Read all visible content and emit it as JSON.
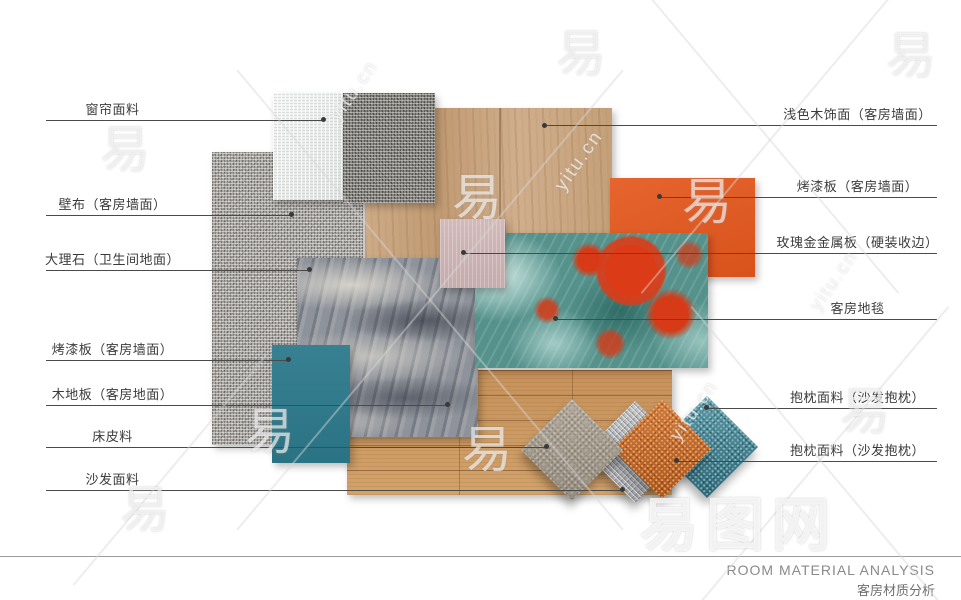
{
  "left_labels": [
    {
      "text": "窗帘面料",
      "material": "curtain-fabric"
    },
    {
      "text": "壁布（客房墙面）",
      "material": "wall-fabric"
    },
    {
      "text": "大理石（卫生间地面）",
      "material": "marble-bathroom-floor"
    },
    {
      "text": "烤漆板（客房墙面）",
      "material": "teal-lacquer-panel"
    },
    {
      "text": "木地板（客房地面）",
      "material": "wood-floor"
    },
    {
      "text": "床皮料",
      "material": "bed-leather"
    },
    {
      "text": "沙发面料",
      "material": "sofa-fabric"
    }
  ],
  "right_labels": [
    {
      "text": "浅色木饰面（客房墙面）",
      "material": "light-wood-veneer"
    },
    {
      "text": "烤漆板（客房墙面）",
      "material": "orange-lacquer-panel"
    },
    {
      "text": "玫瑰金金属板（硬装收边）",
      "material": "rose-gold-metal-panel"
    },
    {
      "text": "客房地毯",
      "material": "guest-room-carpet"
    },
    {
      "text": "抱枕面料（沙发抱枕）",
      "material": "cushion-fabric-teal"
    },
    {
      "text": "抱枕面料（沙发抱枕）",
      "material": "cushion-fabric-orange"
    }
  ],
  "footer": {
    "title_en": "ROOM MATERIAL ANALYSIS",
    "title_zh": "客房材质分析"
  },
  "watermark": {
    "glyph": "易",
    "site_text": "yitu.cn",
    "brand_text": "易图网"
  },
  "colors": {
    "teal_panel": "#2d7a8c",
    "orange_panel": "#e4571d",
    "pink_panel": "#ccb2b2",
    "carpet_teal": "#55928c",
    "carpet_red": "#dc3b17",
    "wood_veneer": "#c8a480",
    "wood_floor": "#cb9a63",
    "label_text": "#3b3b3b",
    "leader_line": "#4a4a4a"
  }
}
